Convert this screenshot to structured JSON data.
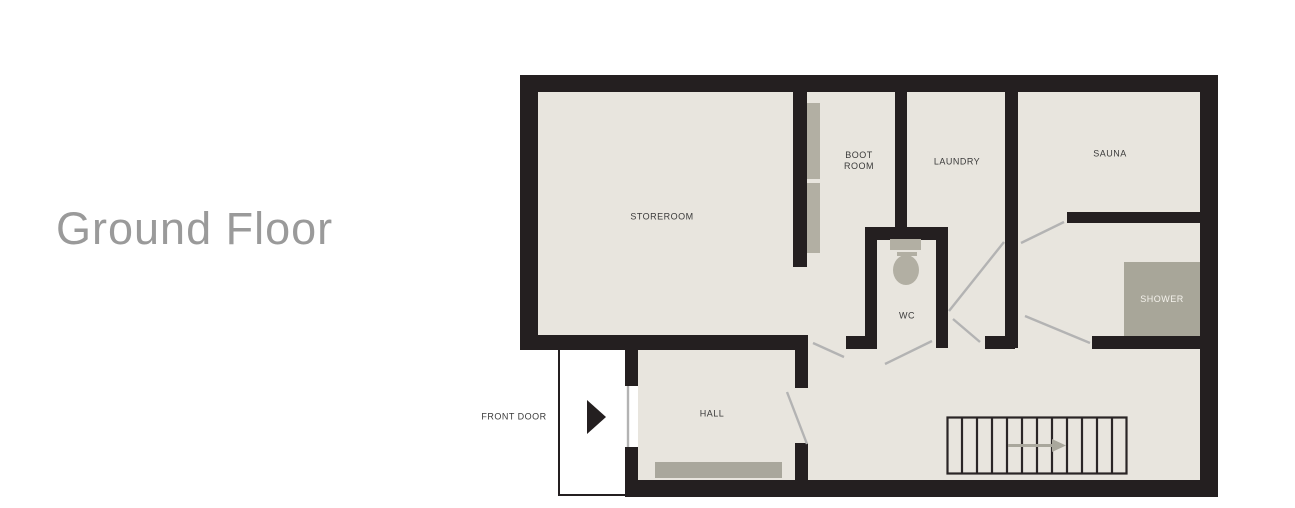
{
  "title": "Ground Floor",
  "rooms": {
    "storeroom": "STOREROOM",
    "boot_room_line1": "BOOT",
    "boot_room_line2": "ROOM",
    "laundry": "LAUNDRY",
    "sauna": "SAUNA",
    "wc": "WC",
    "shower": "SHOWER",
    "hall": "HALL",
    "front_door": "FRONT DOOR"
  },
  "colors": {
    "wall": "#241f20",
    "floor": "#e8e5de",
    "furniture": "#b2afa3",
    "shower_fill": "#a8a699",
    "door_swing": "#b3b3b3",
    "stairs_arrow": "#a9a79c",
    "label_text": "#3a3a3a",
    "title_text": "#9a9a9a",
    "outside": "#ffffff"
  }
}
